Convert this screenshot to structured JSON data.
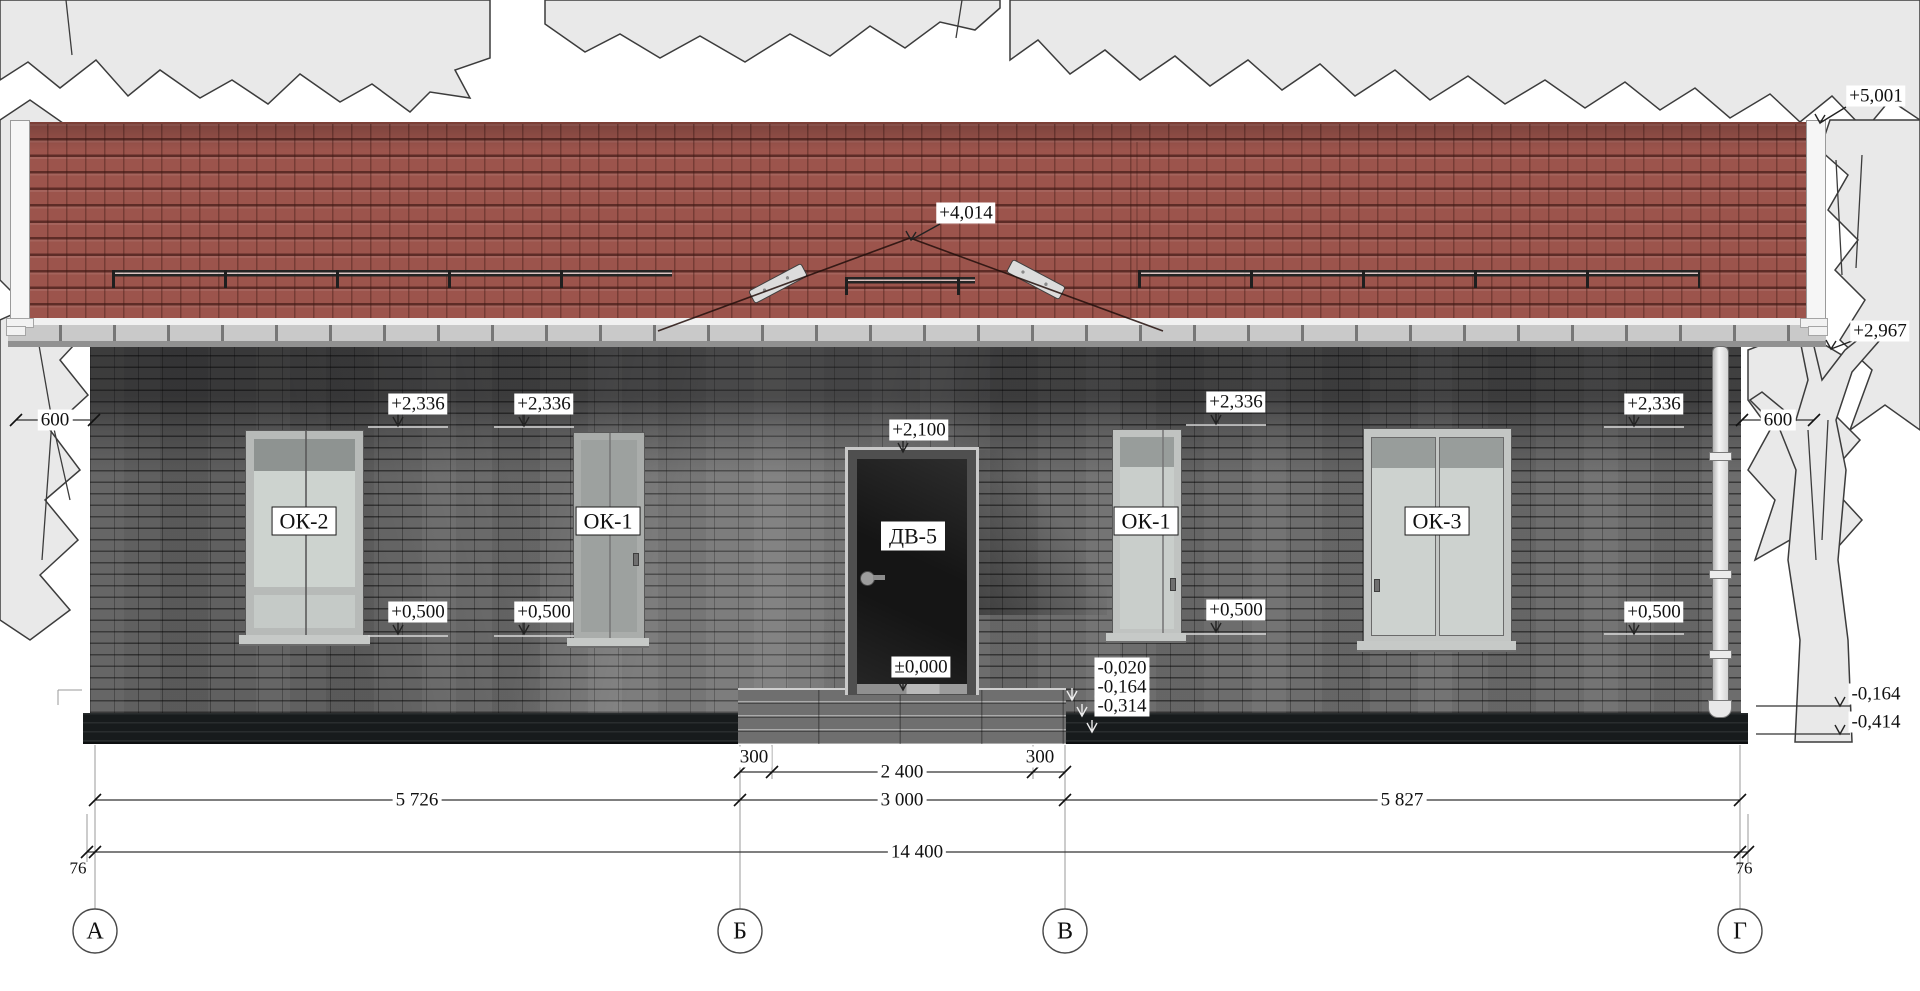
{
  "levels": {
    "plus5001": "+5,001",
    "plus4014": "+4,014",
    "plus2967": "+2,967",
    "plus2336": "+2,336",
    "plus2100": "+2,100",
    "plus0500": "+0,500",
    "zero": "±0,000",
    "m020": "-0,020",
    "m164": "-0,164",
    "m314": "-0,314",
    "m414": "-0,414"
  },
  "dims": {
    "eave_overhang": "600",
    "step_side": "300",
    "step_width": "2 400",
    "span_ab": "5 726",
    "span_bv": "3 000",
    "span_vg": "5 827",
    "total": "14 400",
    "axis_offset": "76"
  },
  "axes": {
    "a": "А",
    "b": "Б",
    "v": "В",
    "g": "Г"
  },
  "openings": {
    "ok2": "ОК-2",
    "ok1": "ОК-1",
    "dv5": "ДВ-5",
    "ok3": "ОК-3"
  },
  "colors": {
    "roof": "#9c544c",
    "brick": "#6d6d6d",
    "plinth": "#171b1c",
    "glass": "#ccd2ce",
    "door": "#151515",
    "trees": "#e9e9e9"
  }
}
